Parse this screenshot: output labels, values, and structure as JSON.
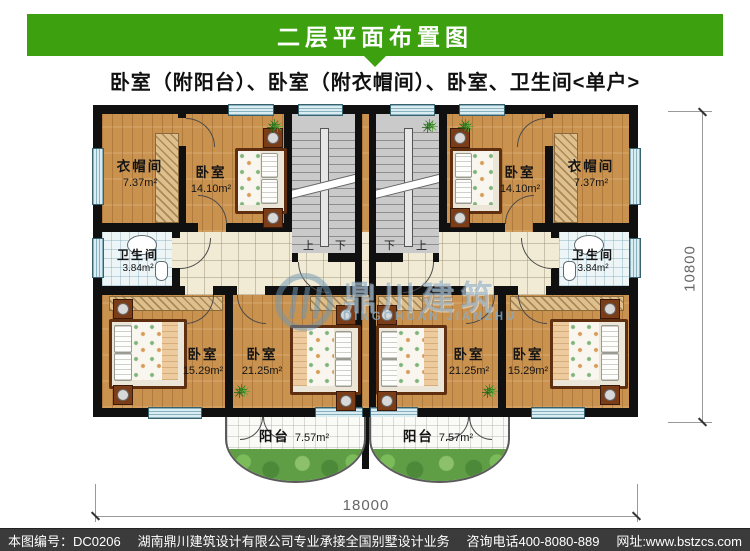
{
  "header": {
    "title": "二层平面布置图"
  },
  "subtitle": "卧室（附阳台）、卧室（附衣帽间）、卧室、卫生间<单户>",
  "rooms": {
    "closet_tl": {
      "name": "衣帽间",
      "area": "7.37m²"
    },
    "bedroom_tl": {
      "name": "卧室",
      "area": "14.10m²"
    },
    "bedroom_tr": {
      "name": "卧室",
      "area": "14.10m²"
    },
    "closet_tr": {
      "name": "衣帽间",
      "area": "7.37m²"
    },
    "bath_l": {
      "name": "卫生间",
      "area": "3.84m²"
    },
    "bath_r": {
      "name": "卫生间",
      "area": "3.84m²"
    },
    "bedroom_bl": {
      "name": "卧室",
      "area": "15.29m²"
    },
    "bedroom_blc": {
      "name": "卧室",
      "area": "21.25m²"
    },
    "bedroom_brc": {
      "name": "卧室",
      "area": "21.25m²"
    },
    "bedroom_br": {
      "name": "卧室",
      "area": "15.29m²"
    },
    "balcony_l": {
      "name": "阳台",
      "area": "7.57m²"
    },
    "balcony_r": {
      "name": "阳台",
      "area": "7.57m²"
    }
  },
  "stairs": {
    "up": "上",
    "down": "下"
  },
  "dimensions": {
    "width_mm": "18000",
    "height_mm": "10800"
  },
  "watermark": {
    "cn": "鼎川建筑",
    "en": "DINGCHUAN JIANZHU"
  },
  "footer": {
    "plan_no": "本图编号：DC0206",
    "company": "湖南鼎川建筑设计有限公司专业承接全国别墅设计业务",
    "phone": "咨询电话400-8080-889",
    "website": "网址:www.bstzcs.com"
  },
  "colors": {
    "header_green": "#3da00e",
    "footer_bg": "#3b3b3b",
    "wall": "#101010",
    "wood_floor": "#c9924f",
    "stair_gray": "#cacaca",
    "window_blue": "#d9edf3",
    "corridor_tile": "#f1ebd6",
    "bath_tile": "#eef5f7",
    "balcony_green": "#5f9e45",
    "watermark_blue": "#7fa6c0"
  }
}
